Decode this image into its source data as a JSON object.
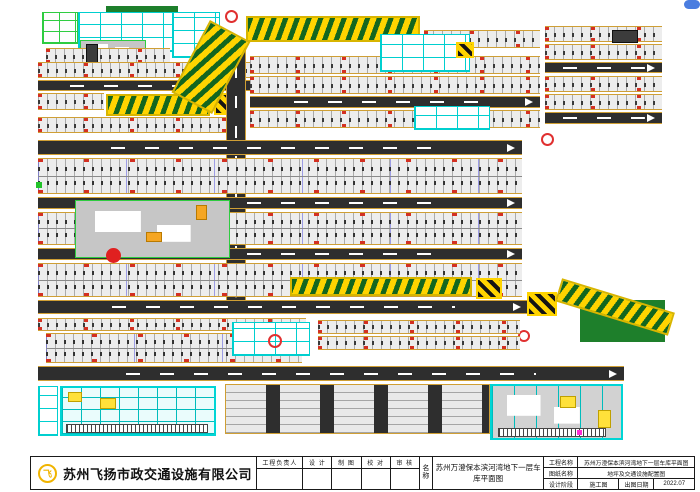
{
  "title_bar": {
    "company": {
      "name": "苏州飞扬市政交通设施有限公司",
      "logo_glyph": "飞",
      "logo_color": "#f0b400"
    },
    "sign_table": {
      "headers": [
        "工程负责人",
        "设 计",
        "制 图",
        "校 对",
        "审 核"
      ]
    },
    "name_block": {
      "label": "名称",
      "value": "苏州万澄保本滨河湾地下一层车库平面图"
    },
    "info_table": {
      "rows": [
        {
          "label": "工程名称",
          "value": "苏州万澄保本滨河湾地下一层车库平面图"
        },
        {
          "label": "图纸名称",
          "value": "地坪及交通设施配置图"
        },
        {
          "label": "设计阶段",
          "value": "施工图",
          "label2": "出图日期",
          "value2": "2022.07"
        }
      ]
    }
  },
  "plan": {
    "legend_colors": {
      "driveway": "#2e2e2e",
      "stall_edge_line": "#cf9f35",
      "ramp_chevron_green": "#13661f",
      "ramp_chevron_yellow": "#ffd400",
      "equipment_room_cyan": "#00d5d5",
      "column_mark_red": "#e02020",
      "core_outline_green": "#2ecc40"
    },
    "blocks": [
      {
        "t": "veg",
        "n": "trees-top",
        "x": 106,
        "y": 6,
        "w": 72,
        "h": 12
      },
      {
        "t": "rooms_g",
        "n": "core-rooms-green",
        "x": 42,
        "y": 12,
        "w": 36,
        "h": 32
      },
      {
        "t": "rooms",
        "n": "core-rooms-cyan",
        "x": 78,
        "y": 12,
        "w": 96,
        "h": 40
      },
      {
        "t": "rooms",
        "n": "core-rooms-cyan",
        "x": 172,
        "y": 12,
        "w": 48,
        "h": 46
      },
      {
        "t": "core",
        "n": "building-core",
        "x": 80,
        "y": 40,
        "w": 66,
        "h": 16
      },
      {
        "t": "stalls",
        "n": "parking-strip",
        "x": 46,
        "y": 48,
        "w": 124,
        "h": 16
      },
      {
        "t": "box_dark",
        "n": "elevator-shaft",
        "x": 86,
        "y": 44,
        "w": 12,
        "h": 22
      },
      {
        "t": "stalls",
        "n": "parking-strip",
        "x": 38,
        "y": 62,
        "w": 212,
        "h": 16
      },
      {
        "t": "road_h",
        "n": "driveway",
        "x": 38,
        "y": 80,
        "w": 212,
        "h": 11
      },
      {
        "t": "stalls",
        "n": "parking-strip",
        "x": 38,
        "y": 93,
        "w": 66,
        "h": 17
      },
      {
        "t": "ramp",
        "n": "speed-ramp",
        "x": 106,
        "y": 94,
        "w": 104,
        "h": 22
      },
      {
        "t": "cross",
        "n": "ramp-hatch-box",
        "x": 214,
        "y": 93,
        "w": 22,
        "h": 22
      },
      {
        "t": "stalls",
        "n": "parking-strip",
        "x": 38,
        "y": 117,
        "w": 196,
        "h": 16
      },
      {
        "t": "road_v",
        "n": "driveway-vertical",
        "x": 226,
        "y": 40,
        "w": 20,
        "h": 264
      },
      {
        "t": "ramp",
        "n": "entry-ramp-curve",
        "x": 188,
        "y": 26,
        "w": 46,
        "h": 82,
        "r": 28
      },
      {
        "t": "ramp",
        "n": "entry-ramp",
        "x": 246,
        "y": 16,
        "w": 174,
        "h": 26
      },
      {
        "t": "bubble",
        "n": "axis-bubble",
        "x": 225,
        "y": 10,
        "w": 13,
        "h": 13
      },
      {
        "t": "stalls",
        "n": "parking-strip",
        "x": 424,
        "y": 30,
        "w": 116,
        "h": 18
      },
      {
        "t": "stalls",
        "n": "parking-strip",
        "x": 250,
        "y": 56,
        "w": 290,
        "h": 18
      },
      {
        "t": "stalls",
        "n": "parking-strip",
        "x": 250,
        "y": 76,
        "w": 290,
        "h": 18
      },
      {
        "t": "rooms",
        "n": "core-rooms-cyan",
        "x": 380,
        "y": 34,
        "w": 90,
        "h": 38
      },
      {
        "t": "cross",
        "n": "ramp-hatch-box",
        "x": 456,
        "y": 42,
        "w": 18,
        "h": 16
      },
      {
        "t": "road_h",
        "n": "driveway",
        "x": 250,
        "y": 96,
        "w": 290,
        "h": 12
      },
      {
        "t": "stalls",
        "n": "parking-strip",
        "x": 250,
        "y": 110,
        "w": 290,
        "h": 18
      },
      {
        "t": "rooms",
        "n": "core-rooms-cyan",
        "x": 414,
        "y": 106,
        "w": 76,
        "h": 24
      },
      {
        "t": "stalls",
        "n": "parking-strip",
        "x": 545,
        "y": 26,
        "w": 117,
        "h": 16
      },
      {
        "t": "stalls",
        "n": "parking-strip",
        "x": 545,
        "y": 44,
        "w": 117,
        "h": 16
      },
      {
        "t": "road_h",
        "n": "driveway",
        "x": 545,
        "y": 62,
        "w": 117,
        "h": 11
      },
      {
        "t": "stalls",
        "n": "parking-strip",
        "x": 545,
        "y": 76,
        "w": 117,
        "h": 16
      },
      {
        "t": "stalls",
        "n": "parking-strip",
        "x": 545,
        "y": 94,
        "w": 117,
        "h": 16
      },
      {
        "t": "road_h",
        "n": "driveway",
        "x": 545,
        "y": 112,
        "w": 117,
        "h": 12
      },
      {
        "t": "box_dark",
        "n": "label-box",
        "x": 612,
        "y": 30,
        "w": 26,
        "h": 13
      },
      {
        "t": "bubble",
        "n": "axis-bubble",
        "x": 541,
        "y": 133,
        "w": 13,
        "h": 13
      },
      {
        "t": "road_h",
        "n": "driveway",
        "x": 38,
        "y": 140,
        "w": 484,
        "h": 15
      },
      {
        "t": "stalls2",
        "n": "parking-double-strip",
        "x": 38,
        "y": 158,
        "w": 484,
        "h": 36
      },
      {
        "t": "road_h",
        "n": "driveway",
        "x": 38,
        "y": 197,
        "w": 484,
        "h": 12
      },
      {
        "t": "stalls2",
        "n": "parking-double-strip",
        "x": 38,
        "y": 212,
        "w": 484,
        "h": 33
      },
      {
        "t": "road_h",
        "n": "driveway",
        "x": 38,
        "y": 248,
        "w": 484,
        "h": 12
      },
      {
        "t": "stalls2",
        "n": "parking-double-strip",
        "x": 38,
        "y": 263,
        "w": 484,
        "h": 34
      },
      {
        "t": "core",
        "n": "building-core",
        "x": 75,
        "y": 200,
        "w": 155,
        "h": 58
      },
      {
        "t": "dotred",
        "n": "fire-equipment-dot",
        "x": 106,
        "y": 248,
        "w": 15,
        "h": 15
      },
      {
        "t": "box_orange",
        "n": "stair-block",
        "x": 196,
        "y": 205,
        "w": 11,
        "h": 15
      },
      {
        "t": "box_orange",
        "n": "stair-block",
        "x": 146,
        "y": 232,
        "w": 16,
        "h": 10
      },
      {
        "t": "ramp",
        "n": "speed-ramp",
        "x": 290,
        "y": 277,
        "w": 182,
        "h": 19
      },
      {
        "t": "cross",
        "n": "ramp-hatch-box",
        "x": 476,
        "y": 278,
        "w": 26,
        "h": 21
      },
      {
        "t": "road_h",
        "n": "driveway",
        "x": 38,
        "y": 300,
        "w": 490,
        "h": 14
      },
      {
        "t": "cross",
        "n": "ramp-hatch-box",
        "x": 527,
        "y": 292,
        "w": 30,
        "h": 24
      },
      {
        "t": "veg",
        "n": "trees-ramp-edge",
        "x": 580,
        "y": 300,
        "w": 85,
        "h": 42
      },
      {
        "t": "ramp",
        "n": "exit-ramp-diagonal",
        "x": 556,
        "y": 295,
        "w": 118,
        "h": 24,
        "r": 17
      },
      {
        "t": "bubble",
        "n": "axis-bubble",
        "x": 518,
        "y": 330,
        "w": 12,
        "h": 12
      },
      {
        "t": "stalls",
        "n": "parking-strip",
        "x": 38,
        "y": 318,
        "w": 268,
        "h": 13
      },
      {
        "t": "stalls2",
        "n": "parking-double-strip",
        "x": 46,
        "y": 333,
        "w": 256,
        "h": 30
      },
      {
        "t": "rooms",
        "n": "core-rooms-cyan",
        "x": 232,
        "y": 322,
        "w": 78,
        "h": 34
      },
      {
        "t": "bubble",
        "n": "axis-bubble",
        "x": 268,
        "y": 334,
        "w": 14,
        "h": 14
      },
      {
        "t": "stalls",
        "n": "parking-strip",
        "x": 318,
        "y": 320,
        "w": 202,
        "h": 14
      },
      {
        "t": "stalls",
        "n": "parking-strip",
        "x": 318,
        "y": 336,
        "w": 202,
        "h": 14
      },
      {
        "t": "road_h",
        "n": "driveway",
        "x": 38,
        "y": 366,
        "w": 586,
        "h": 15
      },
      {
        "t": "rooms",
        "n": "core-rooms-cyan",
        "x": 38,
        "y": 386,
        "w": 20,
        "h": 50
      },
      {
        "t": "equip",
        "n": "equipment-area",
        "x": 60,
        "y": 386,
        "w": 156,
        "h": 50
      },
      {
        "t": "comb",
        "n": "bike-rack",
        "x": 66,
        "y": 424,
        "w": 142,
        "h": 9
      },
      {
        "t": "box_yellow",
        "n": "equipment-box",
        "x": 68,
        "y": 392,
        "w": 14,
        "h": 10
      },
      {
        "t": "box_yellow",
        "n": "equipment-box",
        "x": 100,
        "y": 398,
        "w": 16,
        "h": 11
      },
      {
        "t": "vlot",
        "n": "parking-columns",
        "x": 225,
        "y": 384,
        "w": 265,
        "h": 50
      },
      {
        "t": "equip2",
        "n": "equipment-area",
        "x": 490,
        "y": 384,
        "w": 133,
        "h": 56
      },
      {
        "t": "comb",
        "n": "bike-rack",
        "x": 498,
        "y": 428,
        "w": 108,
        "h": 9
      },
      {
        "t": "box_yellow",
        "n": "equipment-box",
        "x": 560,
        "y": 396,
        "w": 16,
        "h": 12
      },
      {
        "t": "box_yellow",
        "n": "equipment-box",
        "x": 598,
        "y": 410,
        "w": 13,
        "h": 18
      },
      {
        "t": "dot_mag",
        "n": "utility-dot",
        "x": 577,
        "y": 430,
        "w": 5,
        "h": 5
      },
      {
        "t": "dot_green",
        "n": "marker-dot",
        "x": 36,
        "y": 182,
        "w": 6,
        "h": 6
      },
      {
        "t": "pill",
        "n": "scroll-hint-pill",
        "x": 684,
        "y": 0,
        "w": 16,
        "h": 9
      }
    ]
  }
}
